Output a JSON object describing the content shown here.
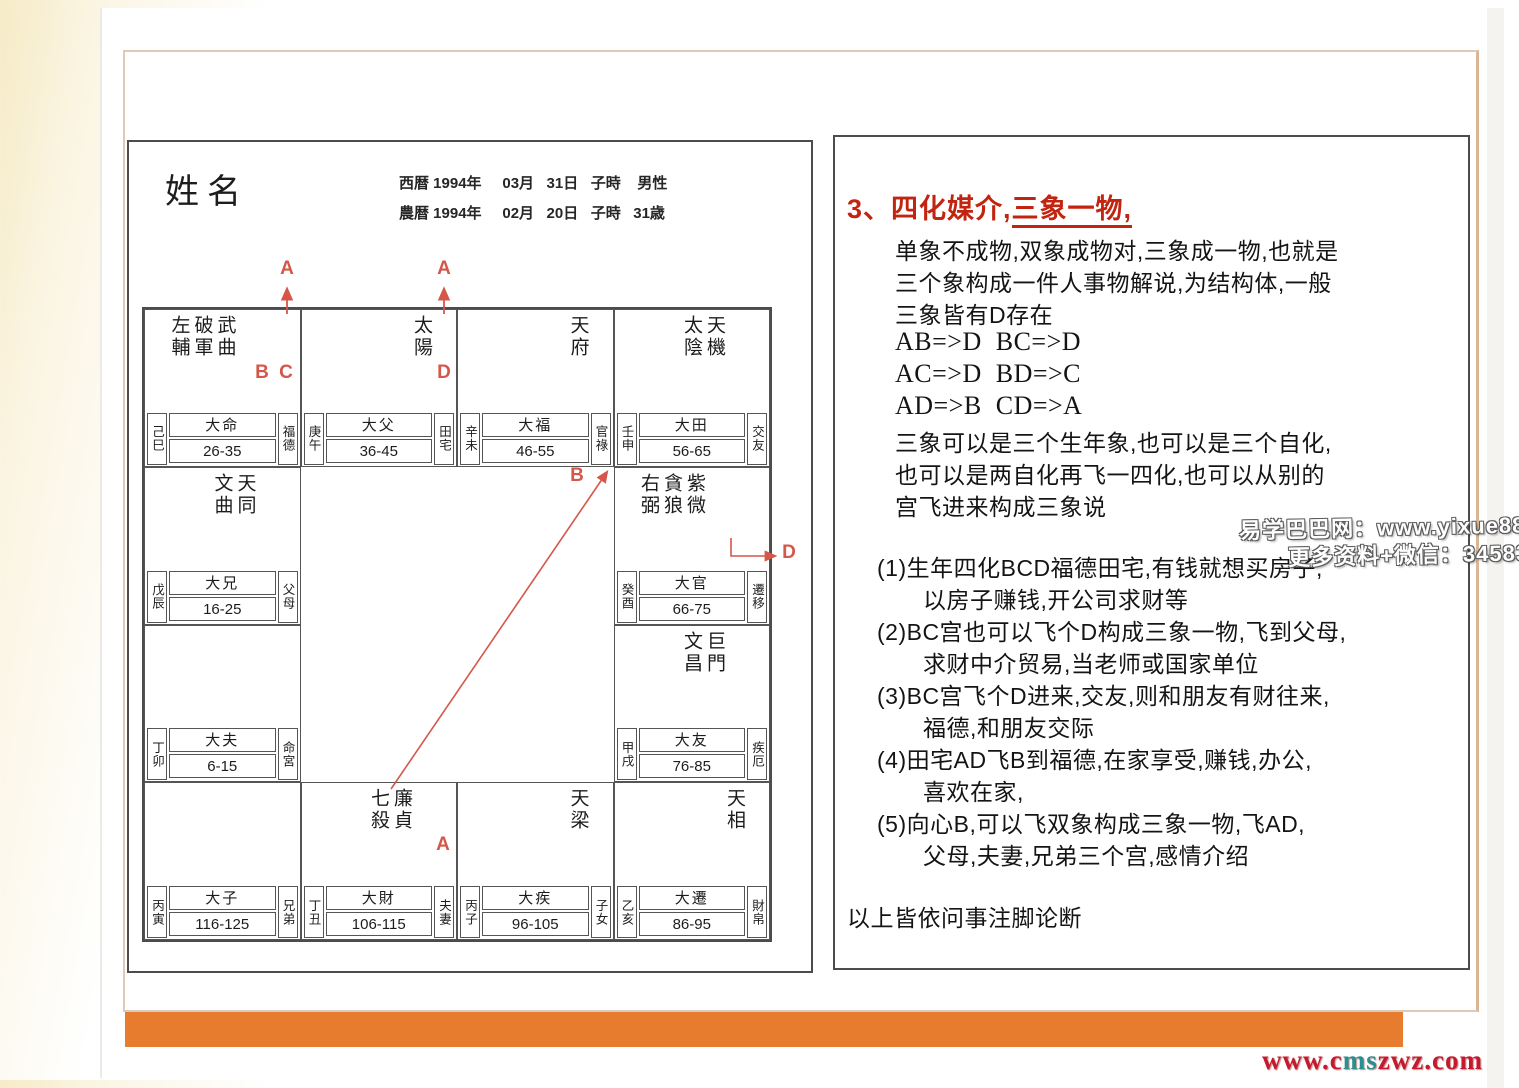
{
  "page": {
    "watermark_line1": "易学巴巴网：www.yixue88.cn",
    "watermark_line2": "更多资料+微信：3458344044",
    "footer_url_p1": "www.c",
    "footer_url_p2": "ms",
    "footer_url_p3": "zwz.com",
    "accent_orange": "#e87c2e",
    "annotation_red": "#d4574a",
    "title_red": "#c22410"
  },
  "chart": {
    "name_label": "姓名",
    "solar_date": "西暦 1994年     03月   31日   子時    男性",
    "lunar_date": "農暦 1994年     02月   20日   子時   31歳",
    "palaces": [
      {
        "branch": "己巳",
        "da_name": "大命",
        "ages": "26-35",
        "natal_name": "福德",
        "stars": [
          "左輔",
          "破軍",
          "武曲"
        ]
      },
      {
        "branch": "庚午",
        "da_name": "大父",
        "ages": "36-45",
        "natal_name": "田宅",
        "stars": [
          "太陽"
        ]
      },
      {
        "branch": "辛未",
        "da_name": "大福",
        "ages": "46-55",
        "natal_name": "官祿",
        "stars": [
          "天府"
        ]
      },
      {
        "branch": "壬申",
        "da_name": "大田",
        "ages": "56-65",
        "natal_name": "交友",
        "stars": [
          "太陰",
          "天機"
        ]
      },
      {
        "branch": "戊辰",
        "da_name": "大兄",
        "ages": "16-25",
        "natal_name": "父母",
        "stars": [
          "文曲",
          "天同"
        ]
      },
      {
        "branch": "癸酉",
        "da_name": "大官",
        "ages": "66-75",
        "natal_name": "遷移",
        "stars": [
          "右弼",
          "貪狼",
          "紫微"
        ]
      },
      {
        "branch": "丁卯",
        "da_name": "大夫",
        "ages": "6-15",
        "natal_name": "命宮",
        "stars": []
      },
      {
        "branch": "甲戌",
        "da_name": "大友",
        "ages": "76-85",
        "natal_name": "疾厄",
        "stars": [
          "文昌",
          "巨門"
        ]
      },
      {
        "branch": "丙寅",
        "da_name": "大子",
        "ages": "116-125",
        "natal_name": "兄弟",
        "stars": []
      },
      {
        "branch": "丁丑",
        "da_name": "大財",
        "ages": "106-115",
        "natal_name": "夫妻",
        "stars": [
          "七殺",
          "廉貞"
        ]
      },
      {
        "branch": "丙子",
        "da_name": "大疾",
        "ages": "96-105",
        "natal_name": "子女",
        "stars": [
          "天梁"
        ]
      },
      {
        "branch": "乙亥",
        "da_name": "大遷",
        "ages": "86-95",
        "natal_name": "財帛",
        "stars": [
          "天相"
        ]
      }
    ],
    "annotations": {
      "a_over_wuqu": "A",
      "a_over_taiyang": "A",
      "b_under_pojun": "B",
      "c_under_wuqu": "C",
      "d_under_taiyang": "D",
      "b_flyline": "B",
      "d_elbow": "D",
      "a_under_lianzhen": "A"
    }
  },
  "panel": {
    "heading_num": "3、",
    "heading_part1": "四化媒介,",
    "heading_part2": "三象一物,",
    "para1": [
      "单象不成物,双象成物对,三象成一物,也就是",
      "三个象构成一件人事物解说,为结构体,一般",
      "三象皆有D存在",
      "AB=>D  BC=>D",
      "AC=>D  BD=>C",
      "AD=>B  CD=>A",
      "三象可以是三个生年象,也可以是三个自化,",
      "也可以是两自化再飞一四化,也可以从别的",
      "宫飞进来构成三象说"
    ],
    "items": [
      "(1)生年四化BCD福德田宅,有钱就想买房子,",
      "以房子赚钱,开公司求财等",
      "(2)BC宫也可以飞个D构成三象一物,飞到父母,",
      "求财中介贸易,当老师或国家单位",
      "(3)BC宫飞个D进来,交友,则和朋友有财往来,",
      "福德,和朋友交际",
      "(4)田宅AD飞B到福德,在家享受,赚钱,办公,",
      "喜欢在家,",
      "(5)向心B,可以飞双象构成三象一物,飞AD,",
      "父母,夫妻,兄弟三个宫,感情介绍"
    ],
    "footer": "以上皆依问事注脚论断"
  }
}
